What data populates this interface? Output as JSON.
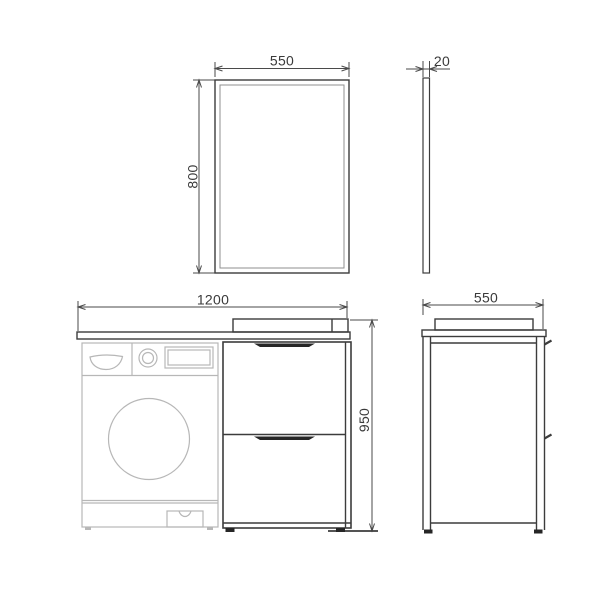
{
  "drawing": {
    "type": "technical-dimension-drawing",
    "subject": "bathroom vanity set with washing machine space and mirror",
    "views": {
      "mirror_front": {
        "width_label": "550",
        "height_label": "800"
      },
      "mirror_side": {
        "thickness_label": "20"
      },
      "vanity_front": {
        "width_label": "1200",
        "height_label": "950"
      },
      "vanity_side": {
        "depth_label": "550"
      }
    },
    "colors": {
      "dimension": "#4a4a4a",
      "outline_dark": "#3c3c3c",
      "outline_light": "#b7b7b7",
      "handle_fill": "#262626",
      "text": "#3a3a3a",
      "background": "#ffffff"
    }
  }
}
